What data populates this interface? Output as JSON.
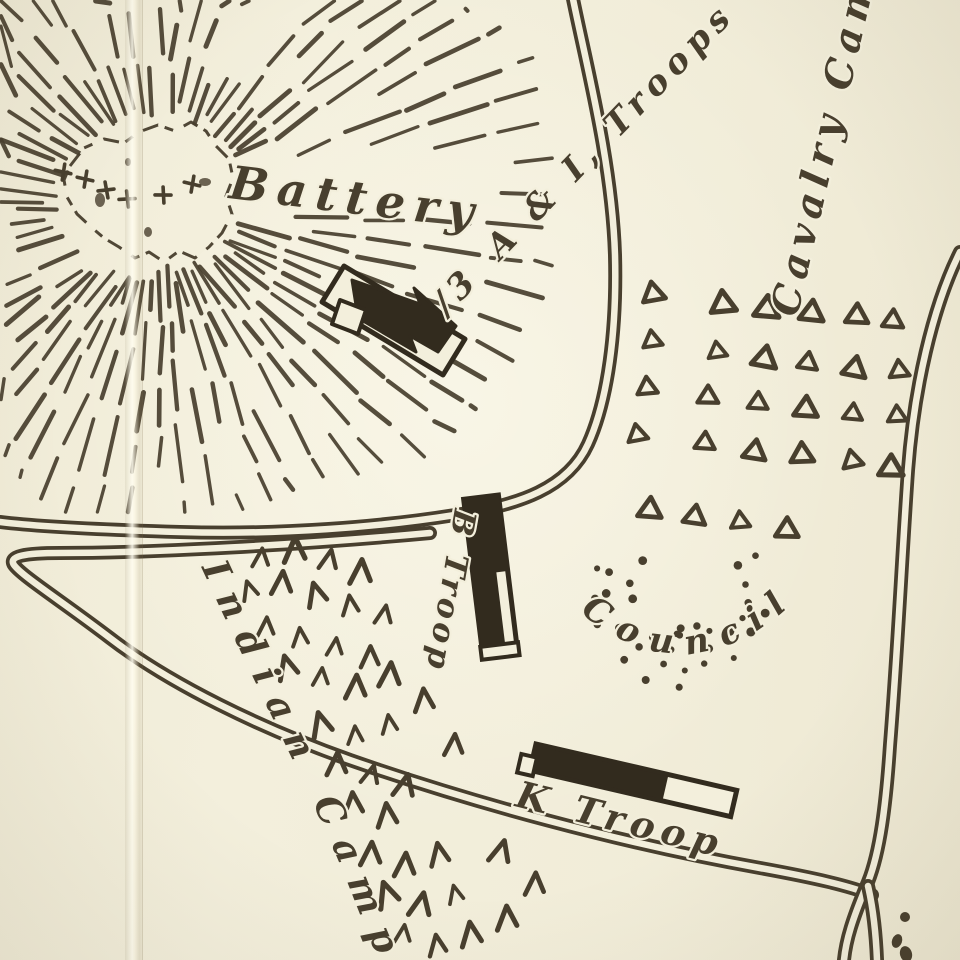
{
  "map": {
    "colors": {
      "paper": "#f3efdc",
      "ink": "#483f2e",
      "ink_dark": "#322b1e"
    },
    "labels": {
      "battery": {
        "text": "Battery"
      },
      "troops_ai": {
        "prefix": "∕3",
        "text": "A & I, Troops"
      },
      "cavalry_camp": {
        "text": "Cavalry Camp"
      },
      "b_troop": {
        "text": "B Troop"
      },
      "k_troop": {
        "text": "K Troop"
      },
      "council": {
        "text": "Council"
      },
      "indian_camp": {
        "text": "Indian Camp"
      }
    },
    "symbols": {
      "cavalry_tents_triangles": [
        [
          653,
          292
        ],
        [
          723,
          302
        ],
        [
          767,
          307
        ],
        [
          812,
          311
        ],
        [
          857,
          314
        ],
        [
          893,
          319
        ],
        [
          652,
          339
        ],
        [
          717,
          350
        ],
        [
          765,
          357
        ],
        [
          808,
          361
        ],
        [
          855,
          367
        ],
        [
          899,
          369
        ],
        [
          647,
          386
        ],
        [
          708,
          395
        ],
        [
          758,
          401
        ],
        [
          806,
          407
        ],
        [
          853,
          412
        ],
        [
          897,
          414
        ],
        [
          637,
          433
        ],
        [
          705,
          441
        ],
        [
          755,
          450
        ],
        [
          802,
          453
        ],
        [
          852,
          459
        ],
        [
          891,
          466
        ],
        [
          650,
          508
        ],
        [
          695,
          515
        ],
        [
          740,
          520
        ],
        [
          787,
          528
        ]
      ],
      "tipi_chevrons": [
        [
          262,
          558
        ],
        [
          296,
          550
        ],
        [
          330,
          560
        ],
        [
          362,
          572
        ],
        [
          250,
          590
        ],
        [
          283,
          583
        ],
        [
          317,
          594
        ],
        [
          351,
          605
        ],
        [
          385,
          615
        ],
        [
          267,
          627
        ],
        [
          301,
          637
        ],
        [
          336,
          647
        ],
        [
          371,
          657
        ],
        [
          288,
          667
        ],
        [
          322,
          677
        ],
        [
          357,
          687
        ],
        [
          391,
          675
        ],
        [
          322,
          724
        ],
        [
          356,
          735
        ],
        [
          390,
          724
        ],
        [
          338,
          764
        ],
        [
          372,
          775
        ],
        [
          406,
          786
        ],
        [
          354,
          804
        ],
        [
          388,
          815
        ],
        [
          425,
          700
        ],
        [
          455,
          745
        ],
        [
          372,
          854
        ],
        [
          406,
          865
        ],
        [
          440,
          854
        ],
        [
          388,
          894
        ],
        [
          422,
          905
        ],
        [
          456,
          894
        ],
        [
          404,
          934
        ],
        [
          438,
          945
        ],
        [
          472,
          934
        ],
        [
          502,
          852
        ],
        [
          536,
          884
        ],
        [
          508,
          918
        ]
      ],
      "gun_crosses": [
        [
          63,
          172
        ],
        [
          85,
          179
        ],
        [
          106,
          190
        ],
        [
          127,
          199
        ],
        [
          163,
          195
        ],
        [
          192,
          184
        ]
      ],
      "council_circle": {
        "center": [
          688,
          592
        ],
        "shells": [
          58,
          78,
          96
        ],
        "angle_start": -30,
        "angle_end": 215,
        "outer_shell_start": 95
      },
      "note_dot": [
        905,
        917
      ]
    },
    "features": {
      "roads": [
        {
          "name": "road-upper-loop",
          "d": "M 572,-6 C 585,60 612,160 615,255 C 617,330 608,400 588,444 C 568,488 520,505 455,515 C 380,527 280,535 180,532 C 110,530 40,527 0,522"
        },
        {
          "name": "road-diagonal-indian-camp",
          "d": "M 430,533 C 300,545 150,553 60,553 C 25,553 8,556 14,565 C 22,576 60,600 110,638 C 170,684 260,728 350,760 C 470,802 620,843 760,868 C 815,878 850,886 872,895"
        },
        {
          "name": "road-right",
          "d": "M 960,252 C 932,308 914,390 908,470 C 902,555 898,645 890,745 C 886,805 880,852 868,882 C 852,920 846,940 844,960"
        },
        {
          "name": "road-right-branch",
          "d": "M 868,886 C 874,912 876,936 877,960"
        }
      ],
      "hill": {
        "center": [
          162,
          208
        ],
        "summit_path": "M 70,166 L 84,148 L 104,139 L 124,143 L 139,132 L 158,125 L 175,131 L 191,122 L 206,131 L 216,146 L 229,159 L 233,178 L 226,196 L 232,214 L 222,233 L 209,247 L 195,258 L 179,251 L 164,262 L 149,252 L 135,258 L 119,247 L 104,238 L 91,227 L 77,214 L 67,197 L 64,180 Z",
        "summit_spots": [
          [
            100,
            200,
            5,
            7
          ],
          [
            148,
            232,
            4,
            5
          ],
          [
            205,
            182,
            6,
            4
          ],
          [
            128,
            162,
            3,
            4
          ]
        ]
      },
      "battery_marker": {
        "outline_pts": "344,266 465,339 443,375 322,302",
        "arrow_pts": "352,280 420,304 414,288 456,326 438,352 410,336 416,352 358,318",
        "tab_pts": "340,300 366,310 358,334 332,324"
      },
      "b_troop_bar": {
        "x": 462,
        "y": 498,
        "rot": -7,
        "w": 38,
        "h": 150,
        "slit": [
          25,
          78,
          9,
          70
        ],
        "open_end": [
          0,
          150,
          38,
          13
        ]
      },
      "k_troop_bar": {
        "x": 536,
        "y": 744,
        "rot": 13,
        "w": 206,
        "h": 27,
        "solid_w": 134,
        "tab": [
          -12,
          13,
          16,
          19
        ]
      },
      "note_fragments": [
        [
          905,
          917,
          5,
          5,
          0
        ],
        [
          897,
          941,
          5,
          7,
          20
        ],
        [
          906,
          954,
          6,
          8,
          -15
        ]
      ]
    }
  }
}
